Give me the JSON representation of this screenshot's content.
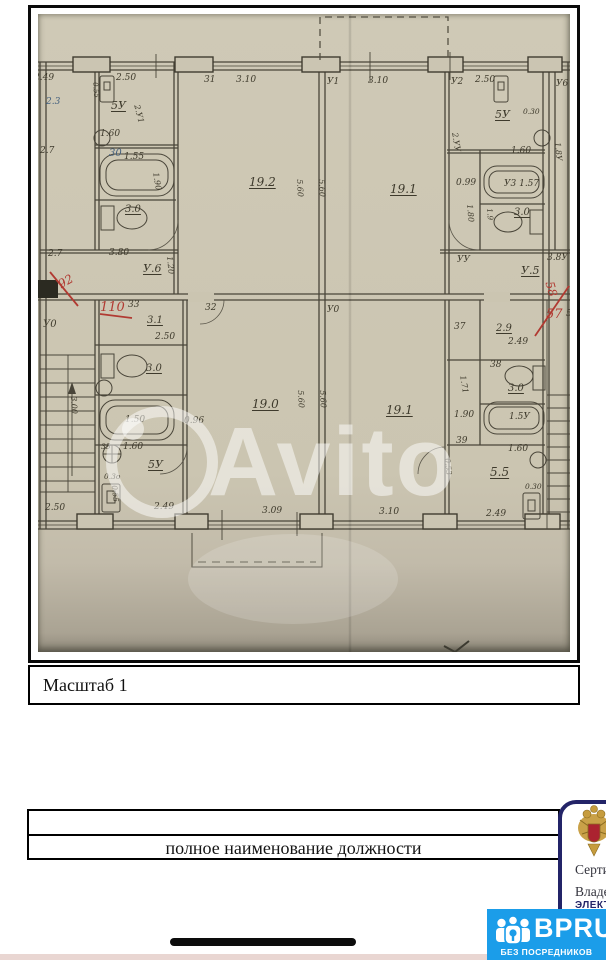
{
  "photo": {
    "watermark": "Avito",
    "scale_label": "Масштаб 1",
    "plan_labels": [
      {
        "t": "2.49",
        "x": -4,
        "y": 60
      },
      {
        "t": "2.50",
        "x": 78,
        "y": 60
      },
      {
        "t": "31",
        "x": 166,
        "y": 62
      },
      {
        "t": "3.10",
        "x": 198,
        "y": 62
      },
      {
        "t": "У1",
        "x": 289,
        "y": 64
      },
      {
        "t": "3.10",
        "x": 330,
        "y": 63
      },
      {
        "t": "У2",
        "x": 413,
        "y": 64
      },
      {
        "t": "2.50",
        "x": 437,
        "y": 62
      },
      {
        "t": "У6",
        "x": 518,
        "y": 66
      },
      {
        "t": "2.3",
        "x": 8,
        "y": 84,
        "c": "blue"
      },
      {
        "t": "2.7",
        "x": 2,
        "y": 133
      },
      {
        "t": "2.7",
        "x": 10,
        "y": 236
      },
      {
        "t": "У0",
        "x": 5,
        "y": 306,
        "s": 10
      },
      {
        "t": "2.50",
        "x": 7,
        "y": 490
      },
      {
        "t": "5У",
        "x": 73,
        "y": 86,
        "u": 1,
        "s": 11
      },
      {
        "t": "0.55",
        "x": 60,
        "y": 68,
        "r": 85,
        "s": 7
      },
      {
        "t": "2.У1",
        "x": 102,
        "y": 90,
        "r": 75,
        "s": 8
      },
      {
        "t": "1.60",
        "x": 62,
        "y": 116
      },
      {
        "t": "30",
        "x": 71,
        "y": 135,
        "c": "blue",
        "s": 10
      },
      {
        "t": "1.55",
        "x": 86,
        "y": 139
      },
      {
        "t": "3.0",
        "x": 87,
        "y": 191,
        "u": 1,
        "s": 10
      },
      {
        "t": "1.90",
        "x": 121,
        "y": 158,
        "r": 80,
        "s": 8
      },
      {
        "t": "3.80",
        "x": 71,
        "y": 235
      },
      {
        "t": "У.6",
        "x": 105,
        "y": 249,
        "u": 1,
        "s": 11
      },
      {
        "t": "1.20",
        "x": 135,
        "y": 242,
        "r": 85,
        "s": 8
      },
      {
        "t": "19.2",
        "x": 211,
        "y": 162,
        "u": 1,
        "s": 12
      },
      {
        "t": "5.60",
        "x": 265,
        "y": 165,
        "r": 87,
        "s": 8
      },
      {
        "t": "5.60",
        "x": 287,
        "y": 165,
        "r": 87,
        "s": 8
      },
      {
        "t": "19.1",
        "x": 352,
        "y": 169,
        "u": 1,
        "s": 12
      },
      {
        "t": "2.УУ",
        "x": 420,
        "y": 118,
        "r": 80,
        "s": 8
      },
      {
        "t": "5У",
        "x": 457,
        "y": 95,
        "u": 1,
        "s": 11
      },
      {
        "t": "0.30",
        "x": 485,
        "y": 94,
        "s": 7.5
      },
      {
        "t": "1.60",
        "x": 473,
        "y": 133
      },
      {
        "t": "0.99",
        "x": 418,
        "y": 165
      },
      {
        "t": "У3 1.57",
        "x": 466,
        "y": 166
      },
      {
        "t": "1.80",
        "x": 435,
        "y": 190,
        "r": 85,
        "s": 8
      },
      {
        "t": "3.0",
        "x": 476,
        "y": 194,
        "u": 1,
        "s": 10
      },
      {
        "t": "1.9",
        "x": 455,
        "y": 194,
        "r": 85,
        "s": 7.5
      },
      {
        "t": "3.8У",
        "x": 509,
        "y": 240
      },
      {
        "t": "УУ",
        "x": 419,
        "y": 242
      },
      {
        "t": "У.5",
        "x": 483,
        "y": 251,
        "u": 1,
        "s": 11
      },
      {
        "t": "1.8У",
        "x": 523,
        "y": 128,
        "r": 85,
        "s": 8
      },
      {
        "t": "92",
        "x": 18,
        "y": 266,
        "c": "red",
        "r": -30,
        "s": 12
      },
      {
        "t": "110",
        "x": 62,
        "y": 287,
        "c": "red",
        "s": 13
      },
      {
        "t": "33",
        "x": 90,
        "y": 287
      },
      {
        "t": "58",
        "x": 517,
        "y": 266,
        "c": "red",
        "r": 75,
        "s": 12
      },
      {
        "t": "57",
        "x": 508,
        "y": 294,
        "c": "red",
        "s": 13
      },
      {
        "t": "5У",
        "x": 528,
        "y": 296
      },
      {
        "t": "32",
        "x": 167,
        "y": 290
      },
      {
        "t": "У0",
        "x": 289,
        "y": 292
      },
      {
        "t": "3.1",
        "x": 109,
        "y": 302,
        "u": 1,
        "s": 10
      },
      {
        "t": "2.50",
        "x": 117,
        "y": 319
      },
      {
        "t": "3.0",
        "x": 108,
        "y": 350,
        "u": 1,
        "s": 10
      },
      {
        "t": "1.50",
        "x": 87,
        "y": 402
      },
      {
        "t": "0.96",
        "x": 146,
        "y": 403
      },
      {
        "t": "3.00",
        "x": 39,
        "y": 382,
        "r": 87,
        "s": 8
      },
      {
        "t": "35",
        "x": 63,
        "y": 429,
        "s": 7.5
      },
      {
        "t": "1.60",
        "x": 85,
        "y": 429
      },
      {
        "t": "5У",
        "x": 110,
        "y": 445,
        "u": 1,
        "s": 11
      },
      {
        "t": "0.3о",
        "x": 66,
        "y": 459,
        "s": 7.5
      },
      {
        "t": "0.55",
        "x": 80,
        "y": 471,
        "r": 85,
        "s": 7.5
      },
      {
        "t": "2.49",
        "x": 116,
        "y": 489
      },
      {
        "t": "19.0",
        "x": 214,
        "y": 384,
        "u": 1,
        "s": 12
      },
      {
        "t": "5.60",
        "x": 266,
        "y": 376,
        "r": 87,
        "s": 8
      },
      {
        "t": "5.60",
        "x": 288,
        "y": 376,
        "r": 87,
        "s": 8
      },
      {
        "t": "3.09",
        "x": 224,
        "y": 493
      },
      {
        "t": "19.1",
        "x": 348,
        "y": 390,
        "u": 1,
        "s": 12
      },
      {
        "t": "3.10",
        "x": 341,
        "y": 494
      },
      {
        "t": "37",
        "x": 416,
        "y": 309
      },
      {
        "t": "2.9",
        "x": 458,
        "y": 310,
        "u": 1,
        "s": 10
      },
      {
        "t": "2.49",
        "x": 470,
        "y": 324
      },
      {
        "t": "38",
        "x": 452,
        "y": 347
      },
      {
        "t": "3.0",
        "x": 470,
        "y": 370,
        "u": 1,
        "s": 10
      },
      {
        "t": "1.71",
        "x": 428,
        "y": 361,
        "r": 80,
        "s": 8
      },
      {
        "t": "1.5У",
        "x": 471,
        "y": 399
      },
      {
        "t": "1.90",
        "x": 416,
        "y": 397
      },
      {
        "t": "39",
        "x": 418,
        "y": 423
      },
      {
        "t": "1.60",
        "x": 470,
        "y": 431
      },
      {
        "t": "5.5",
        "x": 452,
        "y": 452,
        "u": 1,
        "s": 12
      },
      {
        "t": "0.30",
        "x": 487,
        "y": 469,
        "s": 7.5
      },
      {
        "t": "0.53",
        "x": 413,
        "y": 444,
        "r": 85,
        "s": 7.5
      },
      {
        "t": "2.49",
        "x": 448,
        "y": 496
      }
    ]
  },
  "bottom": {
    "position_caption": "полное наименование должности",
    "cert": {
      "line1": "Сертификат",
      "line2": "Владелец",
      "line3": "ЭЛЕКТРОННАЯ"
    },
    "badge": {
      "brand": "BPRU",
      "tagline": "БЕЗ ПОСРЕДНИКОВ"
    }
  },
  "colors": {
    "badge_blue": "#1b9de9",
    "navy": "#232468",
    "red_pen": "#b13a32",
    "photo_paper": "#cbc5b1",
    "plan_ink": "#494539"
  }
}
